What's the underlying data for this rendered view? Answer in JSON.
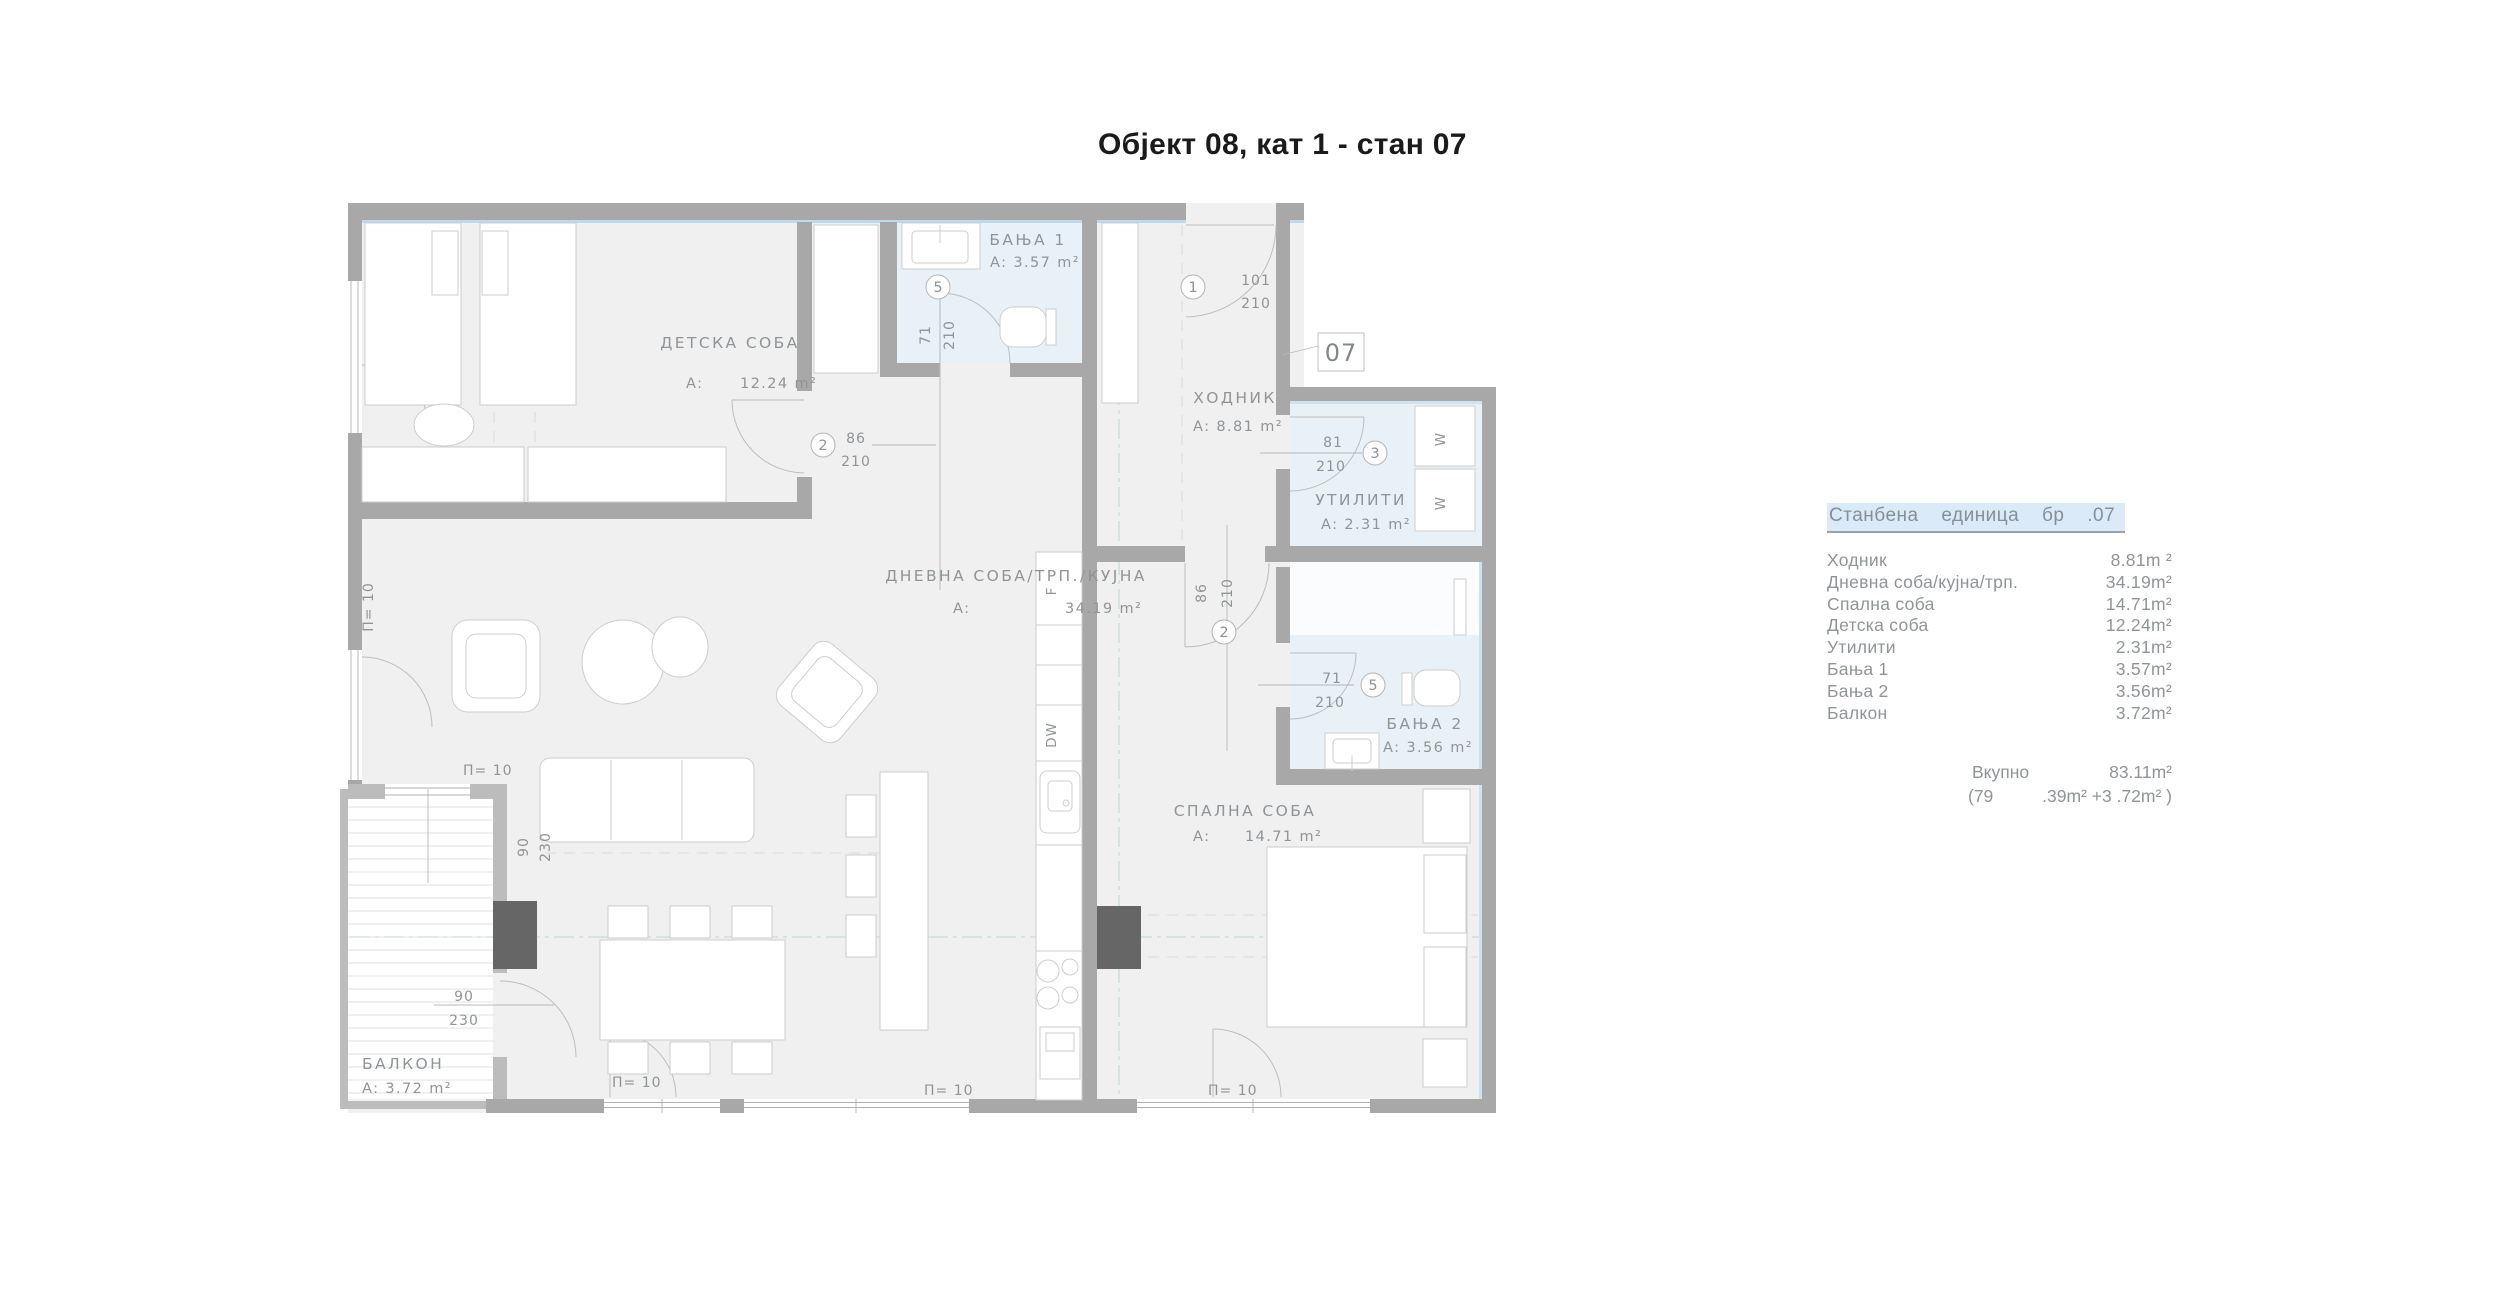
{
  "title": "Објект 08, кат 1 - стан 07",
  "plan": {
    "unit_number": "07",
    "rooms": {
      "detska": {
        "name": "ДЕТСКА СОБА",
        "prefix": "A:",
        "area": "12.24 m²"
      },
      "banja1": {
        "name": "БАЊА 1",
        "area": "A: 3.57 m²"
      },
      "hodnik": {
        "name": "ХОДНИК",
        "area": "A: 8.81 m²"
      },
      "utiliti": {
        "name": "УТИЛИТИ",
        "area": "A: 2.31 m²"
      },
      "dnevna": {
        "name": "ДНЕВНА СОБА/ТРП./КУЈНА",
        "prefix": "A:",
        "area": "34.19 m²"
      },
      "spalna": {
        "name": "СПАЛНА СОБА",
        "prefix": "A:",
        "area": "14.71 m²"
      },
      "banja2": {
        "name": "БАЊА 2",
        "area": "A: 3.56 m²"
      },
      "balkon": {
        "name": "БАЛКОН",
        "area": "A: 3.72 m²"
      }
    },
    "doors": {
      "d1": {
        "no": "1",
        "w": "101",
        "h": "210"
      },
      "d2a": {
        "no": "2",
        "w": "86",
        "h": "210"
      },
      "d2b": {
        "no": "2",
        "w": "86",
        "h": "210"
      },
      "d3": {
        "no": "3",
        "w": "81",
        "h": "210"
      },
      "d5a": {
        "no": "5",
        "w": "71",
        "h": "210"
      },
      "d5b": {
        "no": "5",
        "w": "71",
        "h": "210"
      },
      "balc": {
        "w": "90",
        "h": "230"
      }
    },
    "parapet_label": "П= 10",
    "appliances": {
      "fridge": "F",
      "dishwasher": "DW",
      "washer": "W"
    }
  },
  "legend": {
    "header": "Станбена единица бр .07",
    "rows": [
      {
        "name": "Ходник",
        "value": "8.81m ²"
      },
      {
        "name": "Дневна соба/кујна/трп.",
        "value": "34.19m²"
      },
      {
        "name": "Спална соба",
        "value": "14.71m²"
      },
      {
        "name": "Детска соба",
        "value": "12.24m²"
      },
      {
        "name": "Утилити",
        "value": "2.31m²"
      },
      {
        "name": "Бања 1",
        "value": "3.57m²"
      },
      {
        "name": "Бања 2",
        "value": "3.56m²"
      },
      {
        "name": "Балкон",
        "value": "3.72m²"
      }
    ],
    "total_label": "Вкупно",
    "total_value": "83.11m²",
    "breakdown_open": "(79",
    "breakdown_rest": ".39m² +3 .72m² )"
  },
  "colors": {
    "wall": "#a8a8a8",
    "wall_light": "#bcbcbc",
    "column": "#666666",
    "floor": "#f0f0f1",
    "wet_floor": "#e9f1f8",
    "window_strip": "#bdd9ec",
    "header_bg": "#daeaf8",
    "text_gray": "#8f9497"
  }
}
